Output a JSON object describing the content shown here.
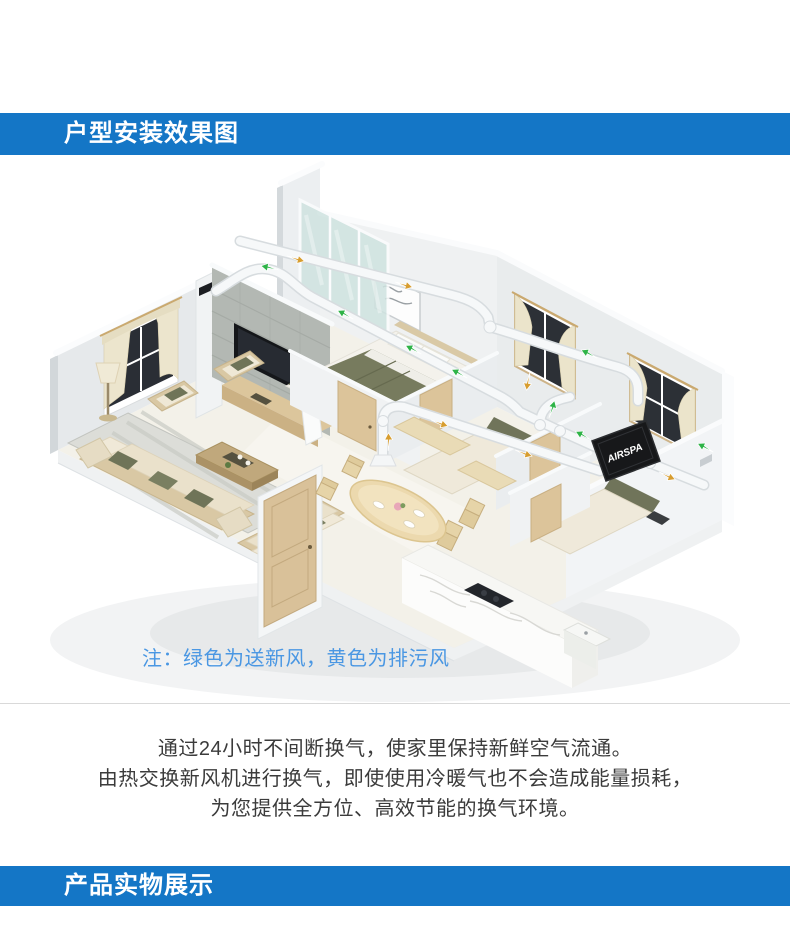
{
  "sections": {
    "install_diagram": {
      "title": "户型安装效果图"
    },
    "product_display": {
      "title": "产品实物展示"
    }
  },
  "diagram": {
    "note": "注：绿色为送新风，黄色为排污风",
    "unit_label": "AIRSPA",
    "supply_color": "#2eb347",
    "exhaust_color": "#d79d2f"
  },
  "description": {
    "line1": "通过24小时不间断换气，使家里保持新鲜空气流通。",
    "line2": "由热交换新风机进行换气，即使使用冷暖气也不会造成能量损耗，",
    "line3": "为您提供全方位、高效节能的换气环境。"
  }
}
